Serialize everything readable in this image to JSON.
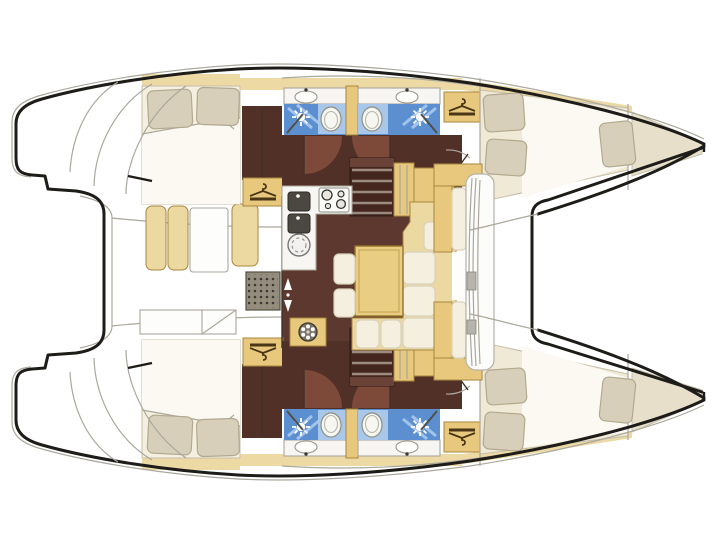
{
  "plan": {
    "type": "floor-plan",
    "subject": "sailing catamaran — top-view interior layout",
    "bow_direction": "right",
    "hulls": 2,
    "cabins": 4,
    "heads": 2
  },
  "areas": {
    "port_hull": {
      "label": "port hull (top)"
    },
    "starboard_hull": {
      "label": "starboard hull (bottom)"
    },
    "aft_cabin": {
      "label": "aft double cabin",
      "features": [
        "double-bed",
        "two-pillows",
        "wardrobe-hanger-icon",
        "closet"
      ]
    },
    "head_aft": {
      "label": "aft head with shower",
      "features": [
        "sink-icon",
        "shower-icon",
        "toilet-icon",
        "glass-partition"
      ]
    },
    "head_fwd": {
      "label": "forward head with shower",
      "features": [
        "sink-icon",
        "shower-icon",
        "toilet-icon",
        "glass-partition"
      ]
    },
    "forward_cabin": {
      "label": "forward double cabin",
      "features": [
        "double-bed",
        "two-pillows",
        "wardrobe-hanger-icon"
      ]
    },
    "bow_berth": {
      "label": "forepeak berth",
      "features": [
        "single-berth",
        "pillow"
      ]
    },
    "companionway": {
      "label": "companionway stairs to hull"
    },
    "salon": {
      "label": "salon on bridgedeck"
    },
    "galley": {
      "label": "L-shaped galley",
      "features": [
        "double-sink-icon",
        "stove-burners-icon",
        "round-hatch-icon"
      ]
    },
    "dinette": {
      "label": "U-shaped dinette",
      "features": [
        "table",
        "settee-cushions",
        "two-stools"
      ]
    },
    "fan_locker": {
      "label": "locker with vent fan icon"
    },
    "forward_cockpit": {
      "label": "forward cockpit bench"
    },
    "trampoline": {
      "label": "bow trampoline platform"
    },
    "aft_cockpit": {
      "label": "aft cockpit",
      "features": [
        "bench-cushions",
        "cockpit-table",
        "slatted-grill",
        "helm-bench"
      ]
    },
    "transom": {
      "label": "transom steps / sugar scoop"
    }
  },
  "colors": {
    "bg": "#ffffff",
    "outline": "#1e1c19",
    "line": "#aaa79c",
    "wall": "#3f332c",
    "deck_tan": "#ecd9a4",
    "tan_strong": "#e7c87d",
    "tan_back": "#ecd9a2",
    "tan_edge": "#a9863e",
    "floor": "#5d382e",
    "corridor": "#513028",
    "wedge": "#7d4a39",
    "stair": "#44261e",
    "tread": "#9b8a7f",
    "blue": "#5c8fcf",
    "blue_light": "#aecdf0",
    "blue_panel": "#a9c7e9",
    "mattress": "#f4efe0",
    "duvet": "#fbf9f2",
    "bed_fwd": "#f0e9d6",
    "berth": "#e7dfc9",
    "bed_edge": "#c6bfa9",
    "pillow": "#d7cfba",
    "pillow_edge": "#b2a98e",
    "cushion": "#f4efdf",
    "cushion_edge": "#d9d2bb",
    "counter": "#f7f6f2",
    "appliance": "#4a4840",
    "table": "#e9cd82",
    "table_edge": "#96722c",
    "white": "#fdfdfb",
    "grill": "#948c7d",
    "latch": "#b7b4ac"
  }
}
